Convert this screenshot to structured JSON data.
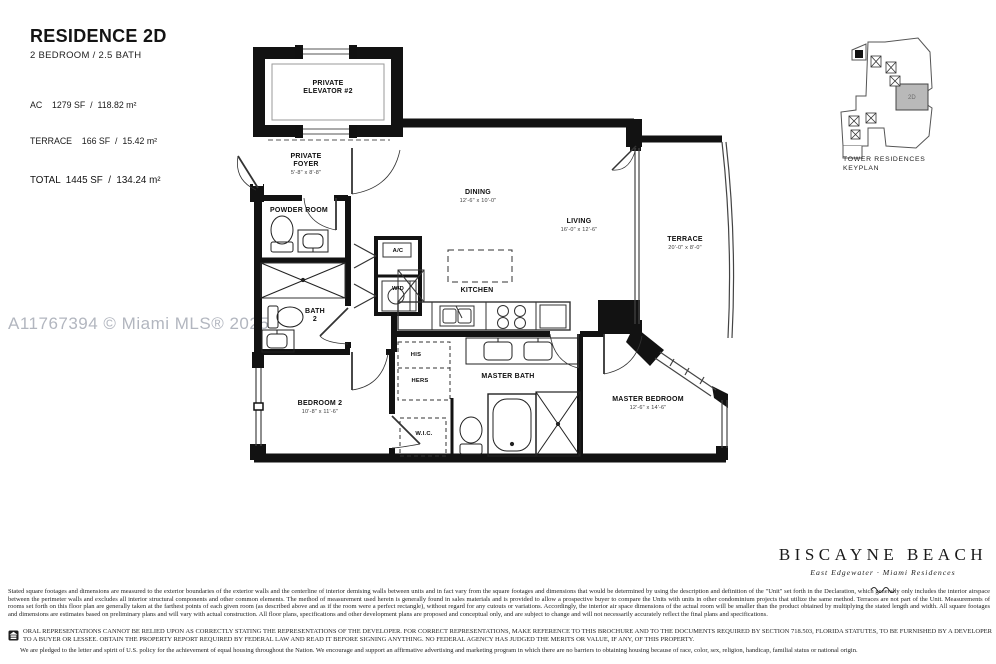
{
  "title_block": {
    "residence": "RESIDENCE 2D",
    "unit_type": "2 BEDROOM / 2.5 BATH",
    "area_ac": "AC    1279 SF  /  118.82 m²",
    "area_terrace": "TERRACE    166 SF  /  15.42 m²",
    "area_total": "TOTAL  1445 SF  /  134.24 m²"
  },
  "watermark": "A11767394 © Miami MLS® 2025",
  "keyplan": {
    "label": "TOWER RESIDENCES\nKEYPLAN",
    "unit": "2D",
    "unit_fill": "#b9b9b9"
  },
  "rooms": {
    "elevator": {
      "label": "PRIVATE\nELEVATOR #2"
    },
    "foyer": {
      "label": "PRIVATE\nFOYER",
      "dims": "5'-8\" x 8'-8\""
    },
    "powder": {
      "label": "POWDER ROOM"
    },
    "bath2": {
      "label": "BATH\n2"
    },
    "ac": {
      "label": "A/C"
    },
    "wd": {
      "label": "W/D"
    },
    "dining": {
      "label": "DINING",
      "dims": "12'-6\" x 10'-0\""
    },
    "living": {
      "label": "LIVING",
      "dims": "16'-0\" x 12'-6\""
    },
    "terrace": {
      "label": "TERRACE",
      "dims": "20'-0\" x 8'-0\""
    },
    "kitchen": {
      "label": "KITCHEN"
    },
    "his": {
      "label": "HIS"
    },
    "hers": {
      "label": "HERS"
    },
    "master_bath": {
      "label": "MASTER BATH"
    },
    "bedroom2": {
      "label": "BEDROOM 2",
      "dims": "10'-8\" x 11'-6\""
    },
    "wic": {
      "label": "W.I.C."
    },
    "master_bedroom": {
      "label": "MASTER BEDROOM",
      "dims": "12'-6\" x 14'-6\""
    }
  },
  "brand": {
    "name": "BISCAYNE BEACH",
    "tagline": "East Edgewater · Miami Residences"
  },
  "legal": {
    "disclaimer": "Stated square footages and dimensions are measured to the exterior boundaries of the exterior walls and the centerline of interior demising walls between units and in fact vary from the square footages and dimensions that would be determined by using the description and definition of the \"Unit\" set forth in the Declaration, which generally only includes the interior airspace between the perimeter walls and excludes all interior structural components and other common elements.  The method of measurement used herein is generally found in sales materials and is provided to allow a prospective buyer to compare the Units with units in other condominium projects that utilize the same method. Terraces are not part of the Unit.  Measurements of rooms set forth on this floor plan are generally taken at the farthest points of each given room (as described above and as if the room were a perfect rectangle), without regard for any cutouts or variations.  Accordingly, the interior air space dimensions of the actual room will be smaller than the product obtained by multiplying the stated length and width.  All square footages and dimensions are estimates based on preliminary plans and will vary with actual construction. All floor plans, specifications and other development plans are proposed and conceptual only, and are subject to change and will not necessarily accurately reflect the final plans and specifications.",
    "oral": "ORAL REPRESENTATIONS CANNOT BE RELIED UPON AS CORRECTLY STATING THE REPRESENTATIONS OF THE DEVELOPER.  FOR CORRECT REPRESENTATIONS, MAKE REFERENCE TO THIS BROCHURE AND TO THE DOCUMENTS REQUIRED BY SECTION 718.503, FLORIDA STATUTES, TO BE FURNISHED BY A DEVELOPER TO A BUYER OR LESSEE. OBTAIN THE PROPERTY REPORT REQUIRED BY FEDERAL LAW AND READ IT BEFORE SIGNING ANYTHING. NO FEDERAL AGENCY HAS JUDGED THE MERITS OR VALUE, IF ANY, OF THIS PROPERTY.",
    "pledge": "We are pledged to the letter and spirit of U.S. policy for the achievement of equal housing throughout the Nation. We encourage and support an affirmative advertising and marketing program in which there are no barriers to obtaining housing because of race, color, sex, religion, handicap, familial status or national origin."
  }
}
